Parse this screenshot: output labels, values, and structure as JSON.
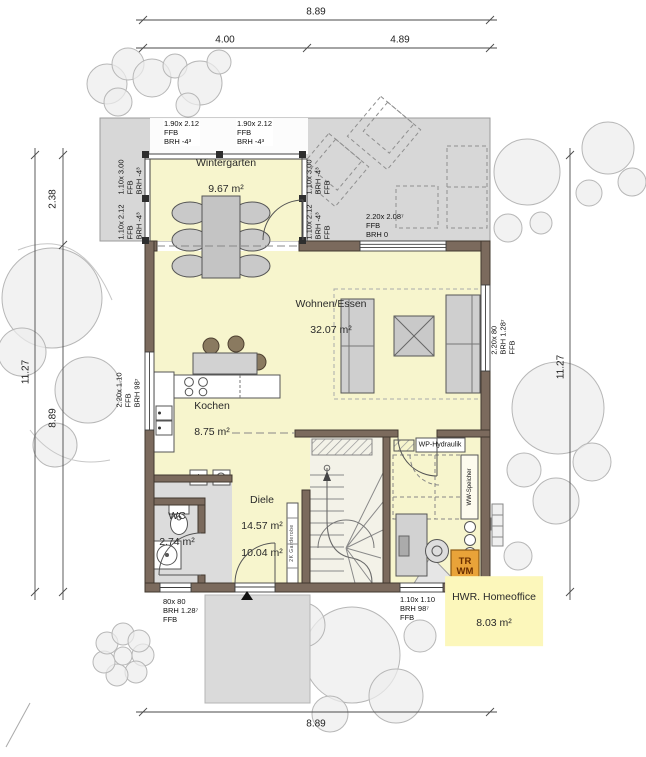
{
  "dimensions": {
    "top_total": "8.89",
    "top_left": "4.00",
    "top_right": "4.89",
    "left_total": "11.27",
    "left_wintergarten": "2.38",
    "left_house": "8.89",
    "right_total": "11.27",
    "bottom_total": "8.89"
  },
  "rooms": {
    "wintergarten": {
      "name": "Wintergarten",
      "area": "9.67 m²"
    },
    "wohnen_essen": {
      "name": "Wohnen/Essen",
      "area": "32.07 m²"
    },
    "kochen": {
      "name": "Kochen",
      "area": "8.75 m²"
    },
    "wc": {
      "name": "WC",
      "area": "2.74 m²"
    },
    "diele": {
      "name": "Diele",
      "area_total": "14.57 m²",
      "area_net": "10.04 m²"
    },
    "hwr": {
      "name": "HWR. Homeoffice",
      "area": "8.03 m²"
    }
  },
  "window_labels": {
    "wintergarten_top_left": "1.90x 2.12\nFFB\nBRH -4³",
    "wintergarten_top_right": "1.90x 2.12\nFFB\nBRH -4³",
    "wintergarten_left_upper": "1.10x 3.00\nFFB\nBRH -4³",
    "wintergarten_left_lower": "1.10x 2.12\nFFB\nBRH -4³",
    "wintergarten_right_upper": "1.10x 3.00\nBRH -4³\nFFB",
    "wintergarten_right_lower": "1.10x 2.12\nBRH -4³\nFFB",
    "terrace_door": "2.20x 2.08⁷\nFFB\nBRH 0",
    "living_east": "2.20x 80\nBRH 1.28⁷\nFFB",
    "kitchen_west": "2.20x 1.10\nFFB\nBRH 98⁷",
    "wc_south": "80x 80\nBRH 1.28⁷\nFFB",
    "hwr_south": "1.10x 1.10\nBRH 98⁷\nFFB"
  },
  "equipment_labels": {
    "wp_hydraulik": "WP-Hydraulik",
    "ww_speicher": "WW-Speicher",
    "dryer_washer": "TR\nWM",
    "garderobe": "2K Garderobe"
  },
  "colors": {
    "wall": "#7b6a5d",
    "room_yellow": "#f7f5cd",
    "terrace_gray": "#d7d7d7",
    "highlight_yellow": "#fcf7bb",
    "appliance_orange": "#e9a339"
  }
}
